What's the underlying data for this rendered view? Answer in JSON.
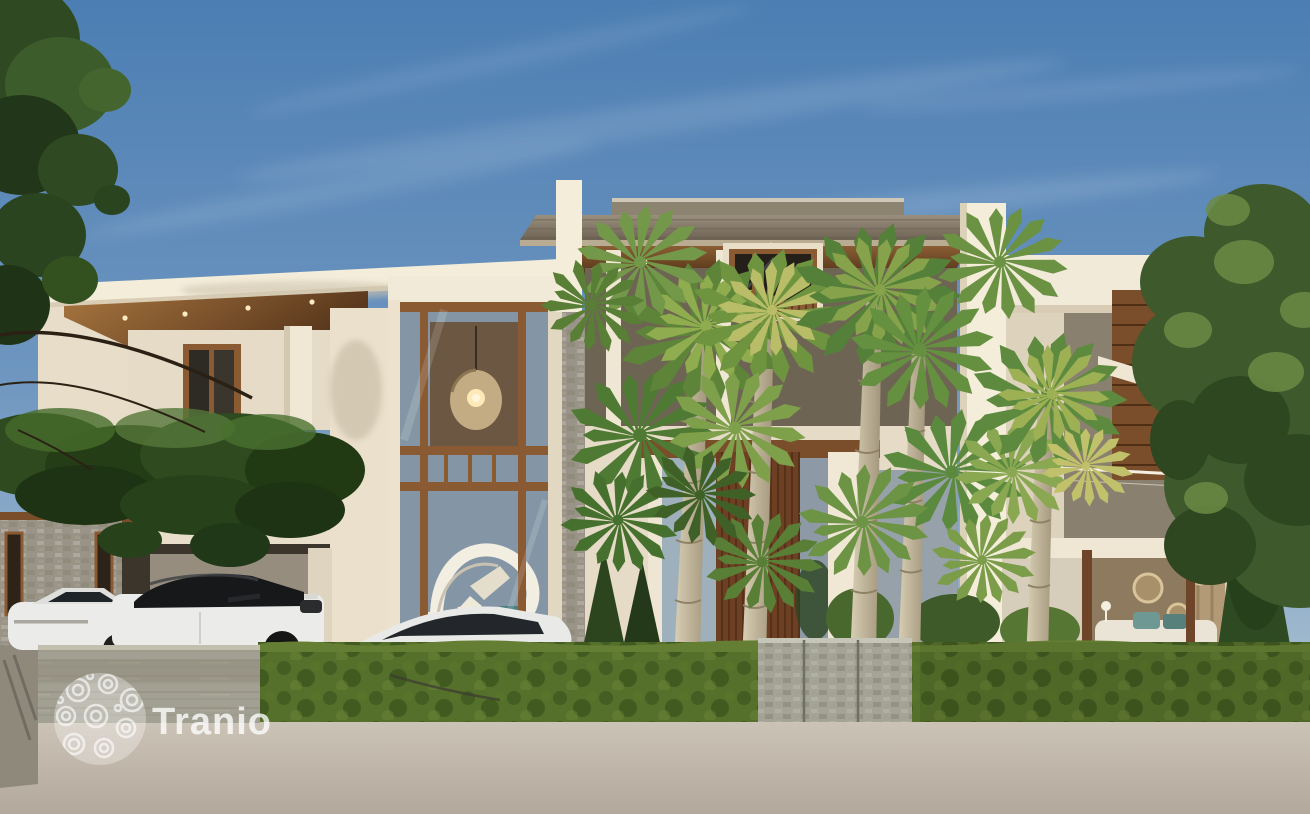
{
  "image": {
    "alt": "3D architectural rendering: modern two-storey tropical villa with wood-framed glass walls, fan palm trees, green hedge, stone gate and three white cars in the driveway under a blue sky"
  },
  "watermark": {
    "text": "Tranio",
    "logo": "spiral-circle-logo",
    "color": "#ffffff"
  },
  "palette": {
    "sky_top": "#4c7eb3",
    "sky_horizon": "#c3ced7",
    "stucco_bright": "#f4edda",
    "stucco_shade": "#e3d9c3",
    "wood": "#8a5a33",
    "wood_dark": "#5e3a1e",
    "door_wood": "#6e4023",
    "roof_gray": "#8d8371",
    "glass_blue": "#8496a6",
    "hedge_green": "#55702b",
    "stone_gate": "#a3a396",
    "concrete_wall": "#a2a093",
    "pavement": "#c0b7aa",
    "palm_green": "#6f9440",
    "palm_yellow": "#b9bd67",
    "tree_green": "#3e5a2c",
    "ivy_green": "#2e4a1e",
    "trunk_tan": "#cfc5a8",
    "car_white": "#ebebe9",
    "car_glass": "#17181a",
    "bed_teal": "#6d9894",
    "interior_warm": "#6b5742"
  }
}
